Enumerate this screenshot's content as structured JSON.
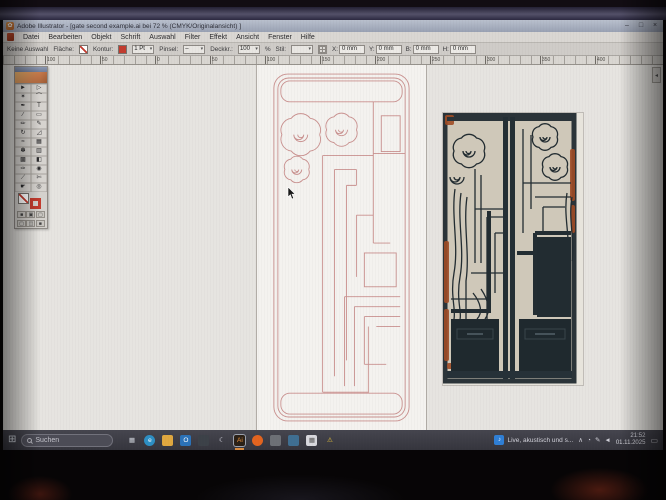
{
  "titlebar": {
    "app_icon_glyph": "✿",
    "title": "Adobe Illustrator - [gate second example.ai bei 72 % (CMYK/Originalansicht) ]",
    "minimize": "–",
    "maximize": "□",
    "close": "×"
  },
  "menubar": {
    "items": [
      {
        "name": "menu-datei",
        "label": "Datei"
      },
      {
        "name": "menu-bearbeiten",
        "label": "Bearbeiten"
      },
      {
        "name": "menu-objekt",
        "label": "Objekt"
      },
      {
        "name": "menu-schrift",
        "label": "Schrift"
      },
      {
        "name": "menu-auswahl",
        "label": "Auswahl"
      },
      {
        "name": "menu-filter",
        "label": "Filter"
      },
      {
        "name": "menu-effekt",
        "label": "Effekt"
      },
      {
        "name": "menu-ansicht",
        "label": "Ansicht"
      },
      {
        "name": "menu-fenster",
        "label": "Fenster"
      },
      {
        "name": "menu-hilfe",
        "label": "Hilfe"
      }
    ]
  },
  "optionsbar": {
    "no_selection": "Keine Auswahl",
    "fill_label": "Fläche:",
    "stroke_label": "Kontur:",
    "stroke_width": "1 Pt",
    "brush_label": "Pinsel:",
    "opacity_label": "Deckkr.:",
    "opacity_value": "100",
    "opacity_unit": "%",
    "style_label": "Stil:",
    "fields": [
      {
        "name": "x-field",
        "label": "X:",
        "value": "0 mm"
      },
      {
        "name": "y-field",
        "label": "Y:",
        "value": "0 mm"
      },
      {
        "name": "width-field",
        "label": "B:",
        "value": "0 mm"
      },
      {
        "name": "height-field",
        "label": "H:",
        "value": "0 mm"
      }
    ]
  },
  "ruler": {
    "ticks": [
      "100",
      "50",
      "0",
      "50",
      "100",
      "150",
      "200",
      "250",
      "300",
      "350",
      "400"
    ]
  },
  "toolbox": {
    "tools": [
      {
        "name": "selection-tool",
        "glyph": "►"
      },
      {
        "name": "direct-selection-tool",
        "glyph": "▷"
      },
      {
        "name": "magic-wand-tool",
        "glyph": "✶"
      },
      {
        "name": "lasso-tool",
        "glyph": "⌒"
      },
      {
        "name": "pen-tool",
        "glyph": "✒"
      },
      {
        "name": "type-tool",
        "glyph": "T"
      },
      {
        "name": "line-segment-tool",
        "glyph": "∕"
      },
      {
        "name": "rectangle-tool",
        "glyph": "▭"
      },
      {
        "name": "paintbrush-tool",
        "glyph": "✏"
      },
      {
        "name": "pencil-tool",
        "glyph": "✎"
      },
      {
        "name": "rotate-tool",
        "glyph": "↻"
      },
      {
        "name": "scale-tool",
        "glyph": "◿"
      },
      {
        "name": "warp-tool",
        "glyph": "≈"
      },
      {
        "name": "free-transform-tool",
        "glyph": "▦"
      },
      {
        "name": "symbol-sprayer-tool",
        "glyph": "✽"
      },
      {
        "name": "graph-tool",
        "glyph": "▥"
      },
      {
        "name": "mesh-tool",
        "glyph": "▩"
      },
      {
        "name": "gradient-tool",
        "glyph": "◧"
      },
      {
        "name": "eyedropper-tool",
        "glyph": "✑"
      },
      {
        "name": "blend-tool",
        "glyph": "◉"
      },
      {
        "name": "slice-tool",
        "glyph": "⟋"
      },
      {
        "name": "scissors-tool",
        "glyph": "✄"
      },
      {
        "name": "hand-tool",
        "glyph": "☛"
      },
      {
        "name": "zoom-tool",
        "glyph": "◎"
      }
    ],
    "paint_buttons": [
      {
        "name": "color-mode-button",
        "glyph": "■"
      },
      {
        "name": "gradient-mode-button",
        "glyph": "▣"
      },
      {
        "name": "none-mode-button",
        "glyph": "▢"
      }
    ],
    "screen_mode_buttons": [
      {
        "name": "standard-screen-button",
        "glyph": "▢"
      },
      {
        "name": "fullscreen-menu-button",
        "glyph": "◫"
      },
      {
        "name": "fullscreen-button",
        "glyph": "■"
      }
    ]
  },
  "panels": {
    "collapse_glyph": "◂"
  },
  "taskbar": {
    "start_glyph": "⊞",
    "search_text": "Suchen",
    "app_icons": [
      {
        "name": "task-view-icon",
        "glyph": "▦",
        "bg": "transparent",
        "fg": "#ccd0d8"
      },
      {
        "name": "edge-icon",
        "glyph": "e",
        "bg": "#2d8fc4",
        "fg": "#ffffff",
        "round": "50%"
      },
      {
        "name": "file-explorer-icon",
        "glyph": "",
        "bg": "#e0a83f",
        "fg": "#ffffff"
      },
      {
        "name": "outlook-icon",
        "glyph": "O",
        "bg": "#2b72b8",
        "fg": "#ffffff"
      },
      {
        "name": "calendar-app-icon",
        "glyph": "",
        "bg": "#3c4148",
        "fg": "#aab0bb"
      },
      {
        "name": "moon-app-icon",
        "glyph": "☾",
        "bg": "transparent",
        "fg": "#e6e6f0"
      },
      {
        "name": "illustrator-icon",
        "glyph": "Ai",
        "bg": "#2a2016",
        "fg": "#e8913f",
        "active": true
      },
      {
        "name": "firefox-icon",
        "glyph": "",
        "bg": "#e3641f",
        "fg": "#ffffff",
        "round": "50%"
      },
      {
        "name": "gray-app-icon",
        "glyph": "",
        "bg": "#6d7076",
        "fg": "#ffffff"
      },
      {
        "name": "blue-app-icon",
        "glyph": "",
        "bg": "#3f6f92",
        "fg": "#ffffff"
      },
      {
        "name": "grid-app-icon",
        "glyph": "▦",
        "bg": "#d8d8dd",
        "fg": "#555555"
      },
      {
        "name": "warning-tray-icon",
        "glyph": "⚠",
        "bg": "transparent",
        "fg": "#e6c23a"
      }
    ],
    "media_widget": {
      "glyph": "♪",
      "text": "Live, akustisch und s..."
    },
    "tray_icons": [
      {
        "name": "hidden-icons-chevron",
        "glyph": "∧"
      },
      {
        "name": "tray-status-icon",
        "glyph": "◔"
      },
      {
        "name": "pen-tray-icon",
        "glyph": "✎"
      },
      {
        "name": "volume-icon",
        "glyph": "◄"
      }
    ],
    "clock": {
      "time": "21:52",
      "date": "01.11.2025"
    },
    "action_center_glyph": "▭"
  },
  "colors": {
    "drawing_stroke": "#c9908e",
    "stroke_red": "#c23b2e",
    "accent_orange": "#d98b3f",
    "gate_dark": "#232d33",
    "rust": "#9e4a26",
    "taskbar_bg": "#3b3b44"
  }
}
